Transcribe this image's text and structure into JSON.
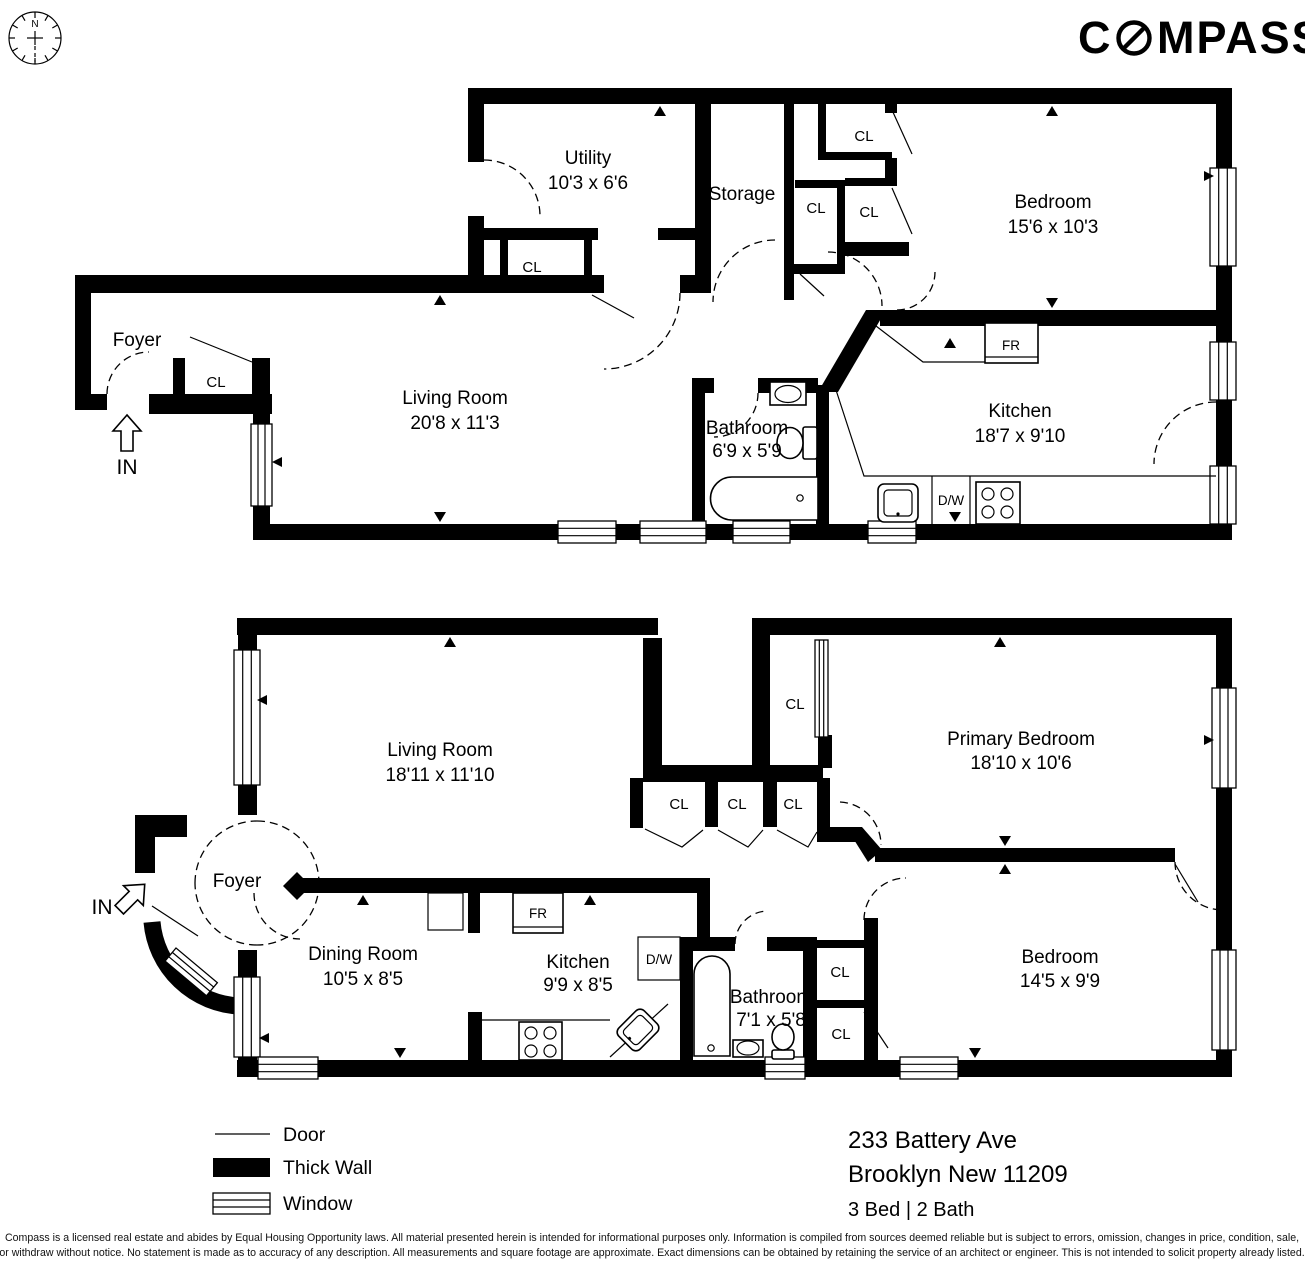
{
  "brand": {
    "prefix": "C",
    "suffix": "MPASS",
    "full": "COMPASS"
  },
  "compass_rose": {
    "north": "N"
  },
  "labels": {
    "closet": "CL",
    "fridge": "FR",
    "dishwasher": "D/W",
    "entry": "IN"
  },
  "floor1": {
    "rooms": {
      "utility": {
        "name": "Utility",
        "dims": "10'3 x 6'6"
      },
      "storage": {
        "name": "Storage",
        "dims": ""
      },
      "bedroom": {
        "name": "Bedroom",
        "dims": "15'6 x 10'3"
      },
      "foyer": {
        "name": "Foyer",
        "dims": ""
      },
      "living": {
        "name": "Living Room",
        "dims": "20'8 x 11'3"
      },
      "bathroom": {
        "name": "Bathroom",
        "dims": "6'9 x 5'9"
      },
      "kitchen": {
        "name": "Kitchen",
        "dims": "18'7 x 9'10"
      }
    }
  },
  "floor2": {
    "rooms": {
      "living": {
        "name": "Living Room",
        "dims": "18'11 x 11'10"
      },
      "primary": {
        "name": "Primary Bedroom",
        "dims": "18'10 x 10'6"
      },
      "foyer": {
        "name": "Foyer",
        "dims": ""
      },
      "dining": {
        "name": "Dining Room",
        "dims": "10'5 x 8'5"
      },
      "kitchen": {
        "name": "Kitchen",
        "dims": "9'9 x 8'5"
      },
      "bathroom": {
        "name": "Bathroom",
        "dims": "7'1 x 5'8"
      },
      "bedroom": {
        "name": "Bedroom",
        "dims": "14'5 x 9'9"
      }
    }
  },
  "legend": {
    "door": "Door",
    "thick_wall": "Thick Wall",
    "window": "Window"
  },
  "address": {
    "line1": "233 Battery Ave",
    "line2": "Brooklyn New 11209",
    "beds_baths": "3 Bed | 2 Bath"
  },
  "disclaimer": {
    "line1": "Compass is a licensed real estate and abides by Equal Housing Opportunity laws. All material presented herein is intended for informational purposes only. Information is compiled from sources deemed reliable but is subject to errors, omission, changes in price, condition, sale,",
    "line2": "or withdraw without notice. No statement is made as to accuracy of any description. All measurements and square footage are approximate. Exact dimensions can be obtained by retaining the service of an architect or engineer. This is not intended to solicit property already listed."
  },
  "colors": {
    "wall": "#000000",
    "background": "#ffffff"
  }
}
